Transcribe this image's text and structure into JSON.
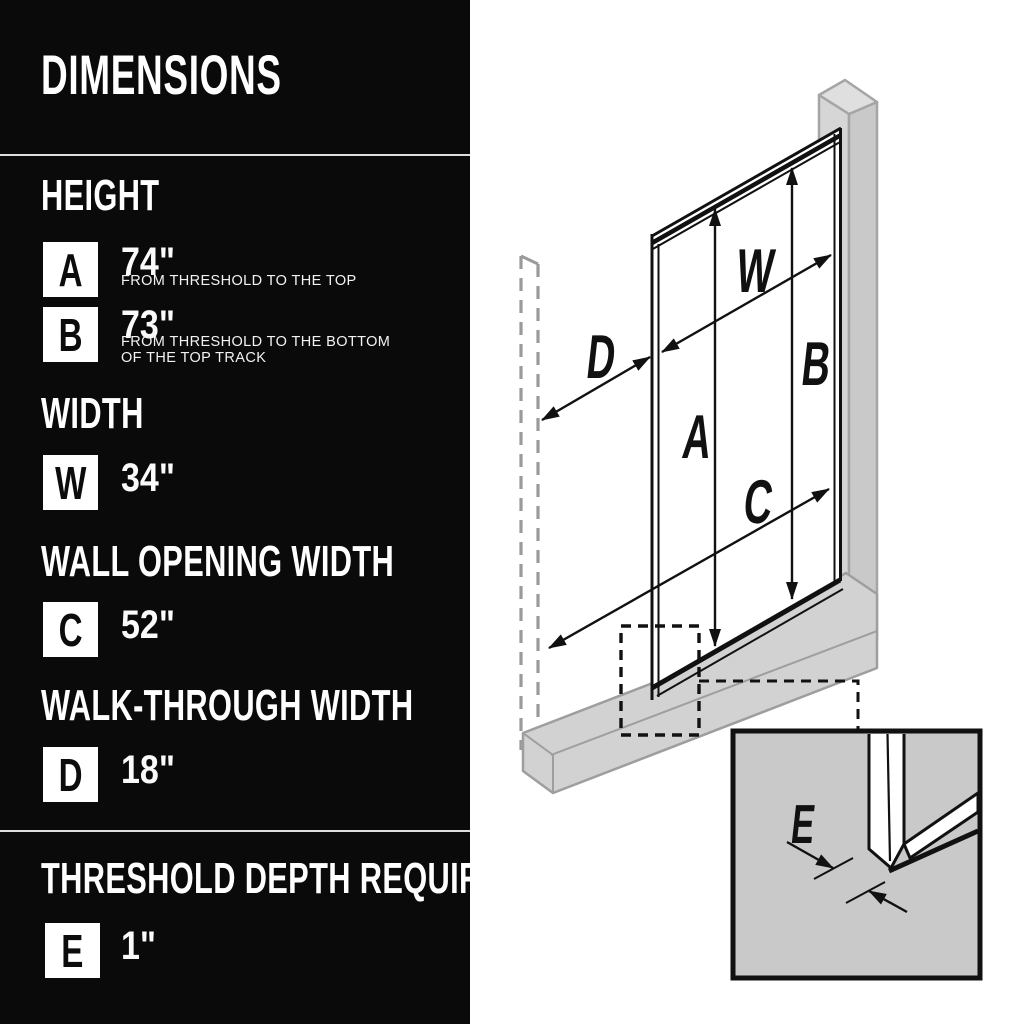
{
  "left_panel": {
    "title": "DIMENSIONS",
    "sections": [
      {
        "header": "HEIGHT",
        "rows": [
          {
            "badge": "A",
            "value": "74\"",
            "desc": "FROM THRESHOLD TO THE TOP"
          },
          {
            "badge": "B",
            "value": "73\"",
            "desc": "FROM THRESHOLD TO THE BOTTOM",
            "desc2": "OF THE TOP TRACK"
          }
        ]
      },
      {
        "header": "WIDTH",
        "rows": [
          {
            "badge": "W",
            "value": "34\""
          }
        ]
      },
      {
        "header": "WALL OPENING WIDTH",
        "rows": [
          {
            "badge": "C",
            "value": "52\""
          }
        ]
      },
      {
        "header": "WALK-THROUGH WIDTH",
        "rows": [
          {
            "badge": "D",
            "value": "18\""
          }
        ]
      },
      {
        "header": "THRESHOLD DEPTH REQUIRED",
        "rows": [
          {
            "badge": "E",
            "value": "1\""
          }
        ]
      }
    ]
  },
  "diagram": {
    "labels": {
      "w": "W",
      "a": "A",
      "b": "B",
      "c": "C",
      "d": "D",
      "e": "E"
    }
  },
  "colors": {
    "panel_bg": "#0a0a0a",
    "panel_text": "#ffffff",
    "divider": "#dedede",
    "line": "#111111",
    "wall_gray": "#d2d2d2",
    "wall_stroke": "#a0a0a0",
    "inset_bg": "#c9c9c9"
  }
}
